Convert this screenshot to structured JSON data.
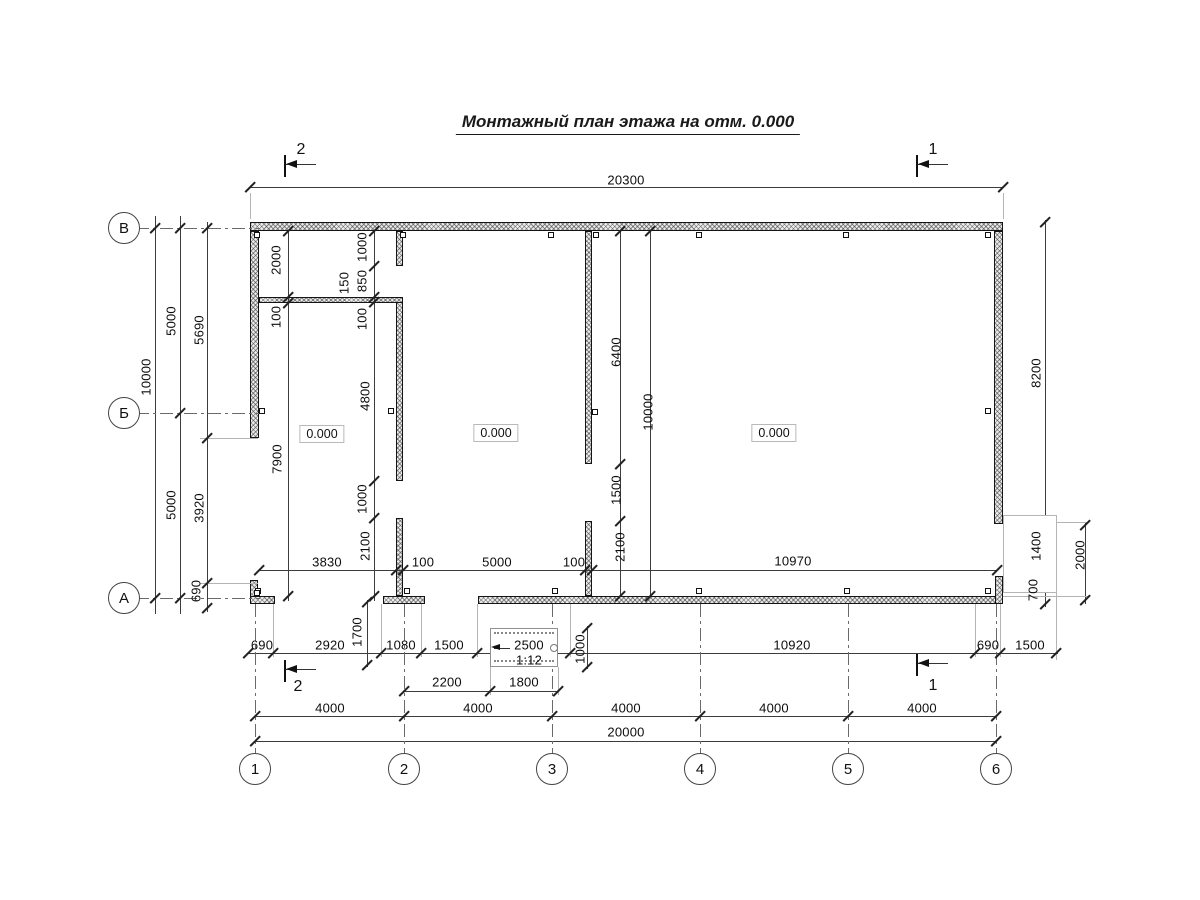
{
  "title": "Монтажный план этажа на отм. 0.000",
  "axes": {
    "left": [
      {
        "label": "В",
        "x": 124,
        "y": 228
      },
      {
        "label": "Б",
        "x": 124,
        "y": 413
      },
      {
        "label": "А",
        "x": 124,
        "y": 598
      }
    ],
    "bottom": [
      {
        "label": "1",
        "x": 255,
        "y": 769
      },
      {
        "label": "2",
        "x": 404,
        "y": 769
      },
      {
        "label": "3",
        "x": 552,
        "y": 769
      },
      {
        "label": "4",
        "x": 700,
        "y": 769
      },
      {
        "label": "5",
        "x": 848,
        "y": 769
      },
      {
        "label": "6",
        "x": 996,
        "y": 769
      }
    ]
  },
  "section_markers": [
    {
      "label": "2",
      "x": 284,
      "y": 155,
      "tx": 301,
      "ty": 150
    },
    {
      "label": "1",
      "x": 916,
      "y": 155,
      "tx": 933,
      "ty": 150
    },
    {
      "label": "2",
      "x": 284,
      "y": 660,
      "tx": 298,
      "ty": 687
    },
    {
      "label": "1",
      "x": 916,
      "y": 654,
      "tx": 933,
      "ty": 686
    }
  ],
  "rooms": [
    {
      "elevation": "0.000",
      "x": 322,
      "y": 434
    },
    {
      "elevation": "0.000",
      "x": 496,
      "y": 433
    },
    {
      "elevation": "0.000",
      "x": 774,
      "y": 433
    }
  ],
  "ramp": {
    "slope_label": "1:12",
    "length_label": "2500"
  },
  "dimension_labels": [
    {
      "text": "20300",
      "x": 626,
      "y": 180,
      "rot": 0
    },
    {
      "text": "8200",
      "x": 1036,
      "y": 373,
      "rot": 1
    },
    {
      "text": "1400",
      "x": 1036,
      "y": 546,
      "rot": 1
    },
    {
      "text": "700",
      "x": 1033,
      "y": 590,
      "rot": 1
    },
    {
      "text": "2000",
      "x": 1080,
      "y": 555,
      "rot": 1
    },
    {
      "text": "10000",
      "x": 146,
      "y": 377,
      "rot": 1
    },
    {
      "text": "5000",
      "x": 171,
      "y": 321,
      "rot": 1
    },
    {
      "text": "5000",
      "x": 171,
      "y": 505,
      "rot": 1
    },
    {
      "text": "5690",
      "x": 199,
      "y": 330,
      "rot": 1
    },
    {
      "text": "3920",
      "x": 199,
      "y": 508,
      "rot": 1
    },
    {
      "text": "690",
      "x": 196,
      "y": 591,
      "rot": 1
    },
    {
      "text": "2000",
      "x": 276,
      "y": 260,
      "rot": 1
    },
    {
      "text": "100",
      "x": 276,
      "y": 317,
      "rot": 1
    },
    {
      "text": "7900",
      "x": 277,
      "y": 459,
      "rot": 1
    },
    {
      "text": "1000",
      "x": 362,
      "y": 247,
      "rot": 1
    },
    {
      "text": "850",
      "x": 362,
      "y": 281,
      "rot": 1
    },
    {
      "text": "150",
      "x": 344,
      "y": 283,
      "rot": 1
    },
    {
      "text": "100",
      "x": 362,
      "y": 319,
      "rot": 1
    },
    {
      "text": "4800",
      "x": 365,
      "y": 396,
      "rot": 1
    },
    {
      "text": "1000",
      "x": 362,
      "y": 499,
      "rot": 1
    },
    {
      "text": "2100",
      "x": 365,
      "y": 546,
      "rot": 1
    },
    {
      "text": "6400",
      "x": 616,
      "y": 352,
      "rot": 1
    },
    {
      "text": "10000",
      "x": 648,
      "y": 412,
      "rot": 1
    },
    {
      "text": "1500",
      "x": 616,
      "y": 490,
      "rot": 1
    },
    {
      "text": "2100",
      "x": 620,
      "y": 547,
      "rot": 1
    },
    {
      "text": "3830",
      "x": 327,
      "y": 562,
      "rot": 0
    },
    {
      "text": "100",
      "x": 423,
      "y": 562,
      "rot": 0
    },
    {
      "text": "5000",
      "x": 497,
      "y": 562,
      "rot": 0
    },
    {
      "text": "100",
      "x": 574,
      "y": 562,
      "rot": 0
    },
    {
      "text": "10970",
      "x": 793,
      "y": 561,
      "rot": 0
    },
    {
      "text": "690",
      "x": 262,
      "y": 645,
      "rot": 0
    },
    {
      "text": "2920",
      "x": 330,
      "y": 645,
      "rot": 0
    },
    {
      "text": "1700",
      "x": 357,
      "y": 632,
      "rot": 1
    },
    {
      "text": "1080",
      "x": 401,
      "y": 645,
      "rot": 0
    },
    {
      "text": "1500",
      "x": 449,
      "y": 645,
      "rot": 0
    },
    {
      "text": "2500",
      "x": 529,
      "y": 645,
      "rot": 0
    },
    {
      "text": "1:12",
      "x": 529,
      "y": 660,
      "rot": 0
    },
    {
      "text": "1000",
      "x": 580,
      "y": 649,
      "rot": 1
    },
    {
      "text": "10920",
      "x": 792,
      "y": 645,
      "rot": 0
    },
    {
      "text": "690",
      "x": 988,
      "y": 645,
      "rot": 0
    },
    {
      "text": "1500",
      "x": 1030,
      "y": 645,
      "rot": 0
    },
    {
      "text": "2200",
      "x": 447,
      "y": 682,
      "rot": 0
    },
    {
      "text": "1800",
      "x": 524,
      "y": 682,
      "rot": 0
    },
    {
      "text": "4000",
      "x": 330,
      "y": 708,
      "rot": 0
    },
    {
      "text": "4000",
      "x": 478,
      "y": 708,
      "rot": 0
    },
    {
      "text": "4000",
      "x": 626,
      "y": 708,
      "rot": 0
    },
    {
      "text": "4000",
      "x": 774,
      "y": 708,
      "rot": 0
    },
    {
      "text": "4000",
      "x": 922,
      "y": 708,
      "rot": 0
    },
    {
      "text": "20000",
      "x": 626,
      "y": 732,
      "rot": 0
    }
  ]
}
